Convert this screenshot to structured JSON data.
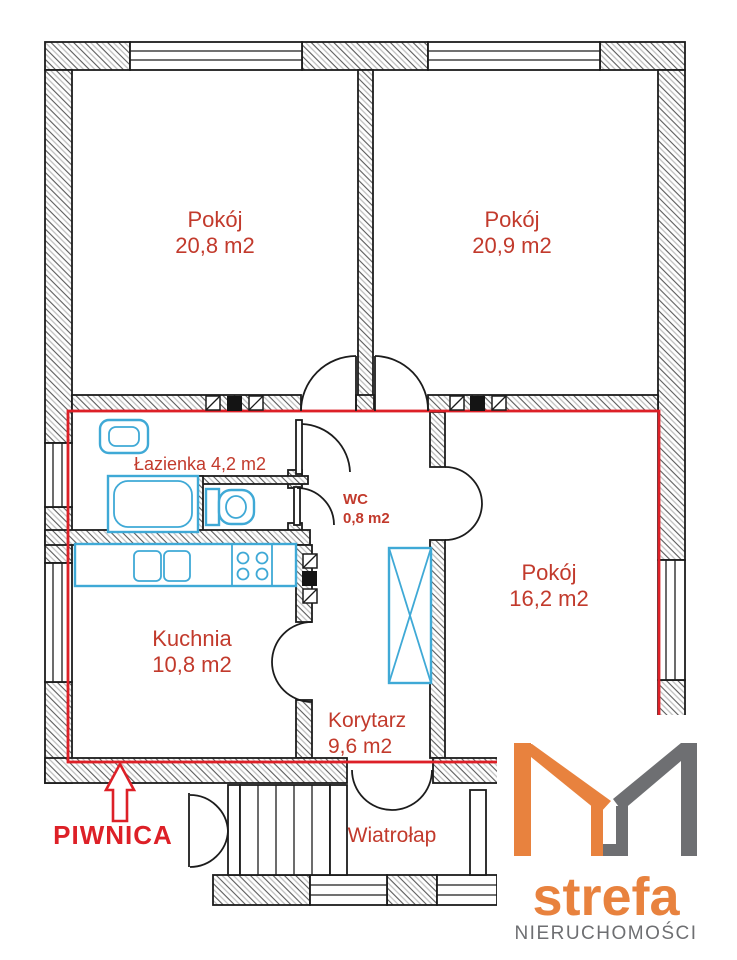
{
  "plan": {
    "rooms": [
      {
        "id": "room-top-left",
        "name": "Pokój",
        "area": "20,8 m2"
      },
      {
        "id": "room-top-right",
        "name": "Pokój",
        "area": "20,9 m2"
      },
      {
        "id": "bathroom",
        "name": "Łazienka",
        "area": "4,2 m2",
        "label": "Łazienka 4,2 m2"
      },
      {
        "id": "wc",
        "name": "WC",
        "area": "0,8 m2"
      },
      {
        "id": "room-right",
        "name": "Pokój",
        "area": "16,2 m2"
      },
      {
        "id": "kitchen",
        "name": "Kuchnia",
        "area": "10,8 m2"
      },
      {
        "id": "corridor",
        "name": "Korytarz",
        "area": "9,6 m2"
      },
      {
        "id": "vestibule",
        "name": "Wiatrołap"
      }
    ],
    "annotations": {
      "basement": "PIWNICA"
    }
  },
  "logo": {
    "brand": "strefa",
    "tagline": "NIERUCHOMOŚCI"
  },
  "colors": {
    "label_red": "#c23a2c",
    "outline_red": "#dd2027",
    "fixture_cyan": "#3fa9d6",
    "logo_orange": "#e8823e",
    "logo_gray": "#6e6f72"
  }
}
